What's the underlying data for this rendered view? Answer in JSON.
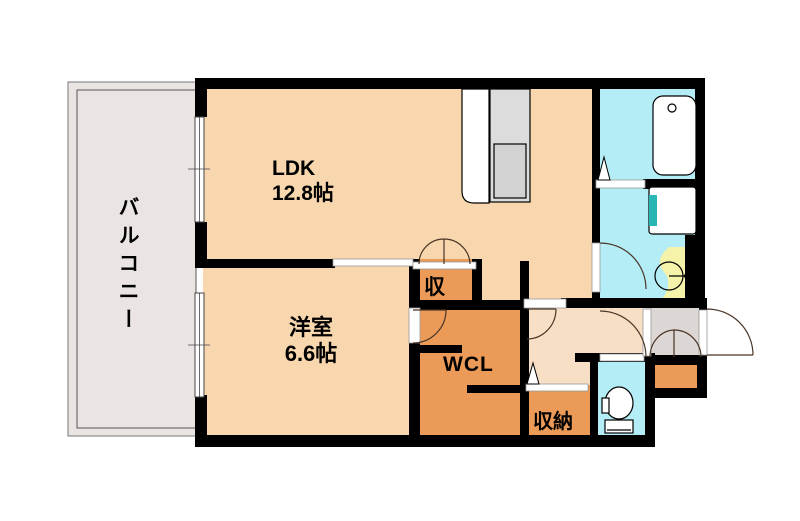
{
  "plan_title": "1LDK apartment floor plan",
  "palette": {
    "wall": "#000000",
    "room": "#f8d7ae",
    "hall": "#f7dfc6",
    "closet": "#eb9a57",
    "wet": "#b4edf5",
    "vanity": "#f5f2a9",
    "balcony": "#eae5e3",
    "entrance": "#dcd6d4",
    "kitchen_unit": "#dcdcdc",
    "kitchen_inner": "#d2d2d2",
    "tap": "#2ab6b4",
    "line": "#4a3526"
  },
  "rooms": {
    "balcony": {
      "label": "バルコニー"
    },
    "ldk": {
      "label": "LDK",
      "size": "12.8帖"
    },
    "western_room": {
      "label": "洋室",
      "size": "6.6帖"
    },
    "closet": {
      "label": "収"
    },
    "walk_in_closet": {
      "label": "WCL"
    },
    "storage": {
      "label": "収納"
    }
  },
  "fixtures": {
    "bathtub": "bathtub-icon",
    "washing_machine_pan": "washing-machine-pan-icon",
    "wash_basin": "wash-basin-icon",
    "toilet": "toilet-icon",
    "kitchen_counter": "kitchen-counter-icon",
    "front_door": "front-door-swing-icon",
    "windows": "sliding-window-icon"
  }
}
